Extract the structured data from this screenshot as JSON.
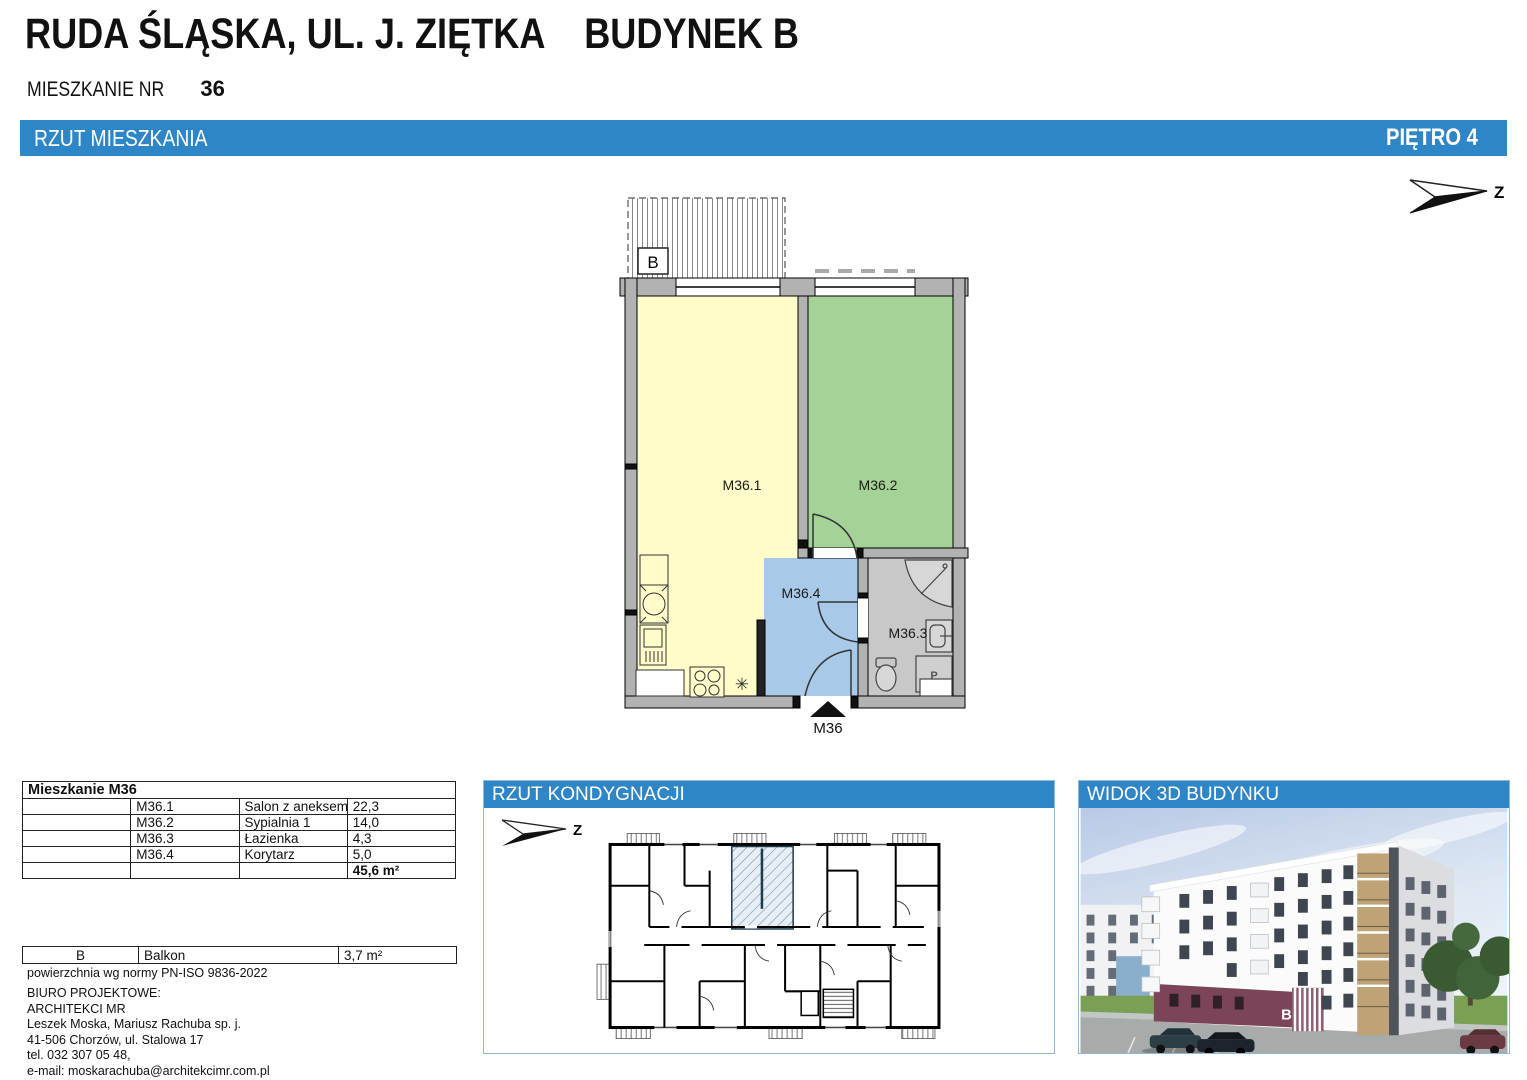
{
  "header": {
    "title": "RUDA ŚLĄSKA, UL. J. ZIĘTKA    BUDYNEK B",
    "apartment_label": "MIESZKANIE NR",
    "apartment_number": "36",
    "section_bar": {
      "left": "RZUT MIESZKANIA",
      "right": "PIĘTRO 4",
      "color": "#2e86c7"
    }
  },
  "plan": {
    "north_label": "Z",
    "balcony_label": "B",
    "entrance_label": "M36",
    "washer_label": "P",
    "boiler_symbol": "✳",
    "rooms": [
      {
        "id": "M36.1",
        "name": "Salon z aneksem kuchennym",
        "color": "#fffcc9"
      },
      {
        "id": "M36.2",
        "name": "Sypialnia 1",
        "color": "#a5d296"
      },
      {
        "id": "M36.3",
        "name": "Łazienka",
        "color": "#c8c8c8"
      },
      {
        "id": "M36.4",
        "name": "Korytarz",
        "color": "#a9c9e9"
      }
    ]
  },
  "area_table": {
    "title": "Mieszkanie M36",
    "rows": [
      {
        "code": "M36.1",
        "name": "Salon z aneksem kuchennym",
        "area": "22,3"
      },
      {
        "code": "M36.2",
        "name": "Sypialnia 1",
        "area": "14,0"
      },
      {
        "code": "M36.3",
        "name": "Łazienka",
        "area": "4,3"
      },
      {
        "code": "M36.4",
        "name": "Korytarz",
        "area": "5,0"
      }
    ],
    "total": "45,6 m²"
  },
  "balcony_table": {
    "code": "B",
    "name": "Balkon",
    "area": "3,7 m²"
  },
  "footnote": "powierzchnia wg normy PN-ISO 9836-2022",
  "office": {
    "lines": [
      "BIURO PROJEKTOWE:",
      "ARCHITEKCI MR",
      "Leszek Moska, Mariusz Rachuba sp. j.",
      "41-506 Chorzów, ul. Stalowa 17",
      "tel. 032 307 05 48,",
      "e-mail: moskarachuba@architekcimr.com.pl"
    ]
  },
  "panels": {
    "floor_plan": {
      "title": "RZUT KONDYGNACJI",
      "north_label": "Z"
    },
    "view_3d": {
      "title": "WIDOK 3D BUDYNKU",
      "building_letter": "B"
    }
  }
}
